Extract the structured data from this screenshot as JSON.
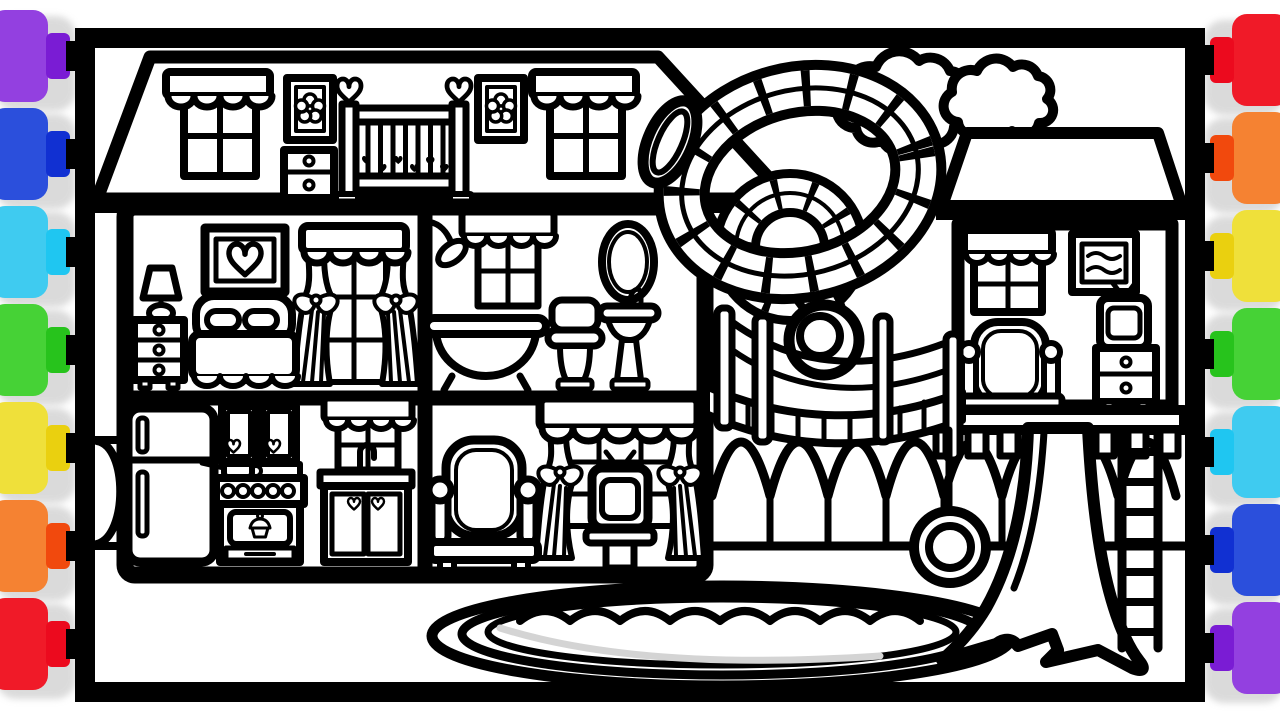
{
  "scene": {
    "kind": "coloring-page-line-art",
    "background": "#ffffff",
    "line_color": "#000000",
    "shadow_color": "#bdbdbd",
    "pool_water_hint": "#d4d4d4",
    "objects": [
      "dollhouse",
      "attic-nursery",
      "bedroom",
      "bathroom",
      "kitchen",
      "living-room",
      "spiral-tube-slide",
      "rope-bridge",
      "treehouse",
      "tree-trunk",
      "ladder",
      "tire-swing",
      "swimming-pool",
      "clouds",
      "bushes",
      "marker-pens"
    ]
  },
  "markers": {
    "left": [
      {
        "name": "purple",
        "body": "#9340E0",
        "cap": "#7A1CD4",
        "nib": "#9C6AF2"
      },
      {
        "name": "blue",
        "body": "#2B4FDC",
        "cap": "#1130D2",
        "nib": "#1E5BEB"
      },
      {
        "name": "cyan",
        "body": "#3FCBF0",
        "cap": "#1FC6F1",
        "nib": "#36E0F8"
      },
      {
        "name": "green",
        "body": "#46D236",
        "cap": "#27C31C",
        "nib": "#3BD72E"
      },
      {
        "name": "yellow",
        "body": "#EFE03A",
        "cap": "#EAD00F",
        "nib": "#EFDB1E"
      },
      {
        "name": "orange",
        "body": "#F58232",
        "cap": "#F1490D",
        "nib": "#F2570E"
      },
      {
        "name": "red",
        "body": "#F01A28",
        "cap": "#EC0A1E",
        "nib": "#E715C5"
      }
    ],
    "right": [
      {
        "name": "red",
        "body": "#F01A28",
        "cap": "#EC0A1E",
        "nib": "#E715C5"
      },
      {
        "name": "orange",
        "body": "#F58232",
        "cap": "#F1490D",
        "nib": "#F2570E"
      },
      {
        "name": "yellow",
        "body": "#EFE03A",
        "cap": "#EAD00F",
        "nib": "#EFDB1E"
      },
      {
        "name": "green",
        "body": "#46D236",
        "cap": "#27C31C",
        "nib": "#3BD72E"
      },
      {
        "name": "cyan",
        "body": "#3FCBF0",
        "cap": "#1FC6F1",
        "nib": "#36E0F8"
      },
      {
        "name": "blue",
        "body": "#2B4FDC",
        "cap": "#1130D2",
        "nib": "#1E5BEB"
      },
      {
        "name": "purple",
        "body": "#9340E0",
        "cap": "#7A1CD4",
        "nib": "#9C6AF2"
      }
    ]
  }
}
